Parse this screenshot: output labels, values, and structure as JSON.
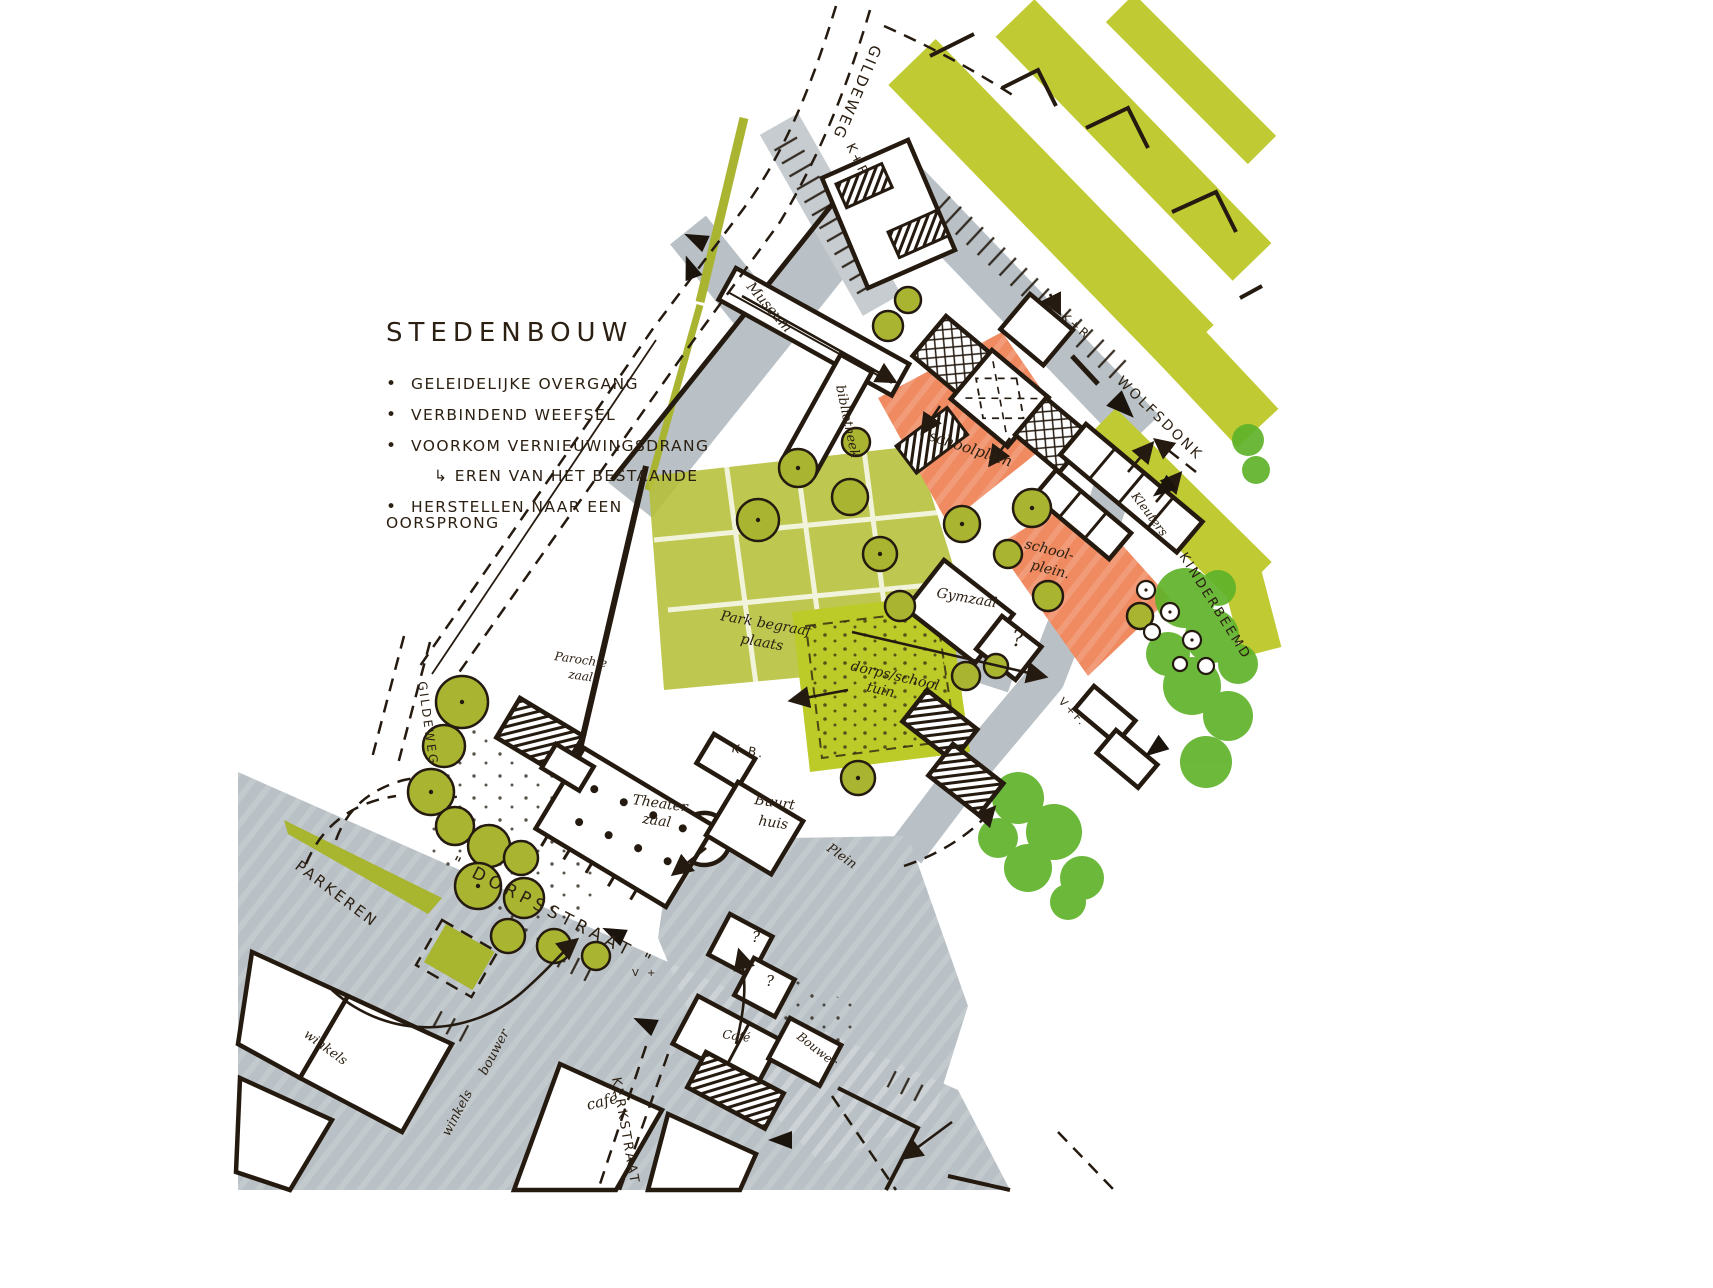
{
  "annotation": {
    "title": "STEDENBOUW",
    "bullets": [
      "GELEIDELIJKE OVERGANG",
      "VERBINDEND WEEFSEL",
      "VOORKOM VERNIEUWINGSDRANG",
      "↳ EREN VAN HET BESTAANDE",
      "HERSTELLEN NAAR EEN OORSPRONG"
    ]
  },
  "colors": {
    "road_gray": "#b9c1c6",
    "kr_gray": "#c6ccd0",
    "marker_olive": "#c0ca33",
    "cemetery_olive": "#b5bf37",
    "tuin_green": "#bccb28",
    "tree_olive": "#a9b431",
    "orange": "#ef8a61",
    "bright_green": "#5fb32a",
    "ink": "#241a10"
  },
  "map": {
    "labels": [
      {
        "id": "gildeweg-top",
        "text": "GILDEWEG",
        "x": 872,
        "y": 44,
        "rot": 113,
        "fs": 15,
        "cls": "caps"
      },
      {
        "id": "kr-top",
        "text": "K+R",
        "x": 846,
        "y": 146,
        "rot": 64,
        "fs": 13,
        "cls": "caps"
      },
      {
        "id": "museum",
        "text": "Museum",
        "x": 746,
        "y": 287,
        "rot": 49,
        "fs": 14,
        "cls": "hand"
      },
      {
        "id": "bibliotheek",
        "text": "bibliotheek",
        "x": 836,
        "y": 386,
        "rot": 78,
        "fs": 13,
        "cls": "hand"
      },
      {
        "id": "kr-2",
        "text": "↓ K+R",
        "x": 1046,
        "y": 306,
        "rot": 40,
        "fs": 12,
        "cls": "caps"
      },
      {
        "id": "wolfsdonk",
        "text": "WOLFSDONK",
        "x": 1116,
        "y": 382,
        "rot": 44,
        "fs": 14,
        "cls": "caps"
      },
      {
        "id": "schoolplein-boven",
        "text": "schoolplein",
        "x": 928,
        "y": 440,
        "rot": 18,
        "fs": 15,
        "cls": "hand"
      },
      {
        "id": "schoolplein-onder-a",
        "text": "school-",
        "x": 1024,
        "y": 548,
        "rot": 14,
        "fs": 14,
        "cls": "hand"
      },
      {
        "id": "schoolplein-onder-b",
        "text": "plein.",
        "x": 1030,
        "y": 569,
        "rot": 14,
        "fs": 14,
        "cls": "hand"
      },
      {
        "id": "kleuters",
        "text": "Kleuters",
        "x": 1131,
        "y": 496,
        "rot": 53,
        "fs": 12,
        "cls": "hand"
      },
      {
        "id": "kinderbeemd",
        "text": "KINDERBEEMD",
        "x": 1179,
        "y": 556,
        "rot": 58,
        "fs": 13,
        "cls": "caps"
      },
      {
        "id": "gymzaal",
        "text": "Gymzaal",
        "x": 936,
        "y": 597,
        "rot": 10,
        "fs": 14,
        "cls": "hand"
      },
      {
        "id": "vraagteken-gym",
        "text": "?",
        "x": 1012,
        "y": 646,
        "rot": 0,
        "fs": 22,
        "cls": "hand"
      },
      {
        "id": "vf",
        "text": "V+F.",
        "x": 1058,
        "y": 702,
        "rot": 46,
        "fs": 11,
        "cls": "caps"
      },
      {
        "id": "tuin-a",
        "text": "dorps/school",
        "x": 850,
        "y": 670,
        "rot": 13,
        "fs": 14,
        "cls": "hand"
      },
      {
        "id": "tuin-b",
        "text": "tuin",
        "x": 866,
        "y": 691,
        "rot": 13,
        "fs": 14,
        "cls": "hand"
      },
      {
        "id": "begraaf-a",
        "text": "Park begraaf",
        "x": 720,
        "y": 620,
        "rot": 10,
        "fs": 14,
        "cls": "hand"
      },
      {
        "id": "begraaf-b",
        "text": "plaats",
        "x": 740,
        "y": 643,
        "rot": 10,
        "fs": 14,
        "cls": "hand"
      },
      {
        "id": "parochie-a",
        "text": "Parochie",
        "x": 554,
        "y": 660,
        "rot": 8,
        "fs": 12,
        "cls": "hand"
      },
      {
        "id": "parochie-b",
        "text": "zaal",
        "x": 568,
        "y": 678,
        "rot": 8,
        "fs": 12,
        "cls": "hand"
      },
      {
        "id": "gildeweg-links",
        "text": "GILDEWEG",
        "x": 418,
        "y": 682,
        "rot": 82,
        "fs": 12,
        "cls": "caps"
      },
      {
        "id": "kb",
        "text": "K.B.",
        "x": 731,
        "y": 752,
        "rot": 10,
        "fs": 12,
        "cls": "caps"
      },
      {
        "id": "theater-a",
        "text": "Theater",
        "x": 632,
        "y": 804,
        "rot": 8,
        "fs": 14,
        "cls": "hand"
      },
      {
        "id": "theater-b",
        "text": "zaal",
        "x": 642,
        "y": 823,
        "rot": 8,
        "fs": 14,
        "cls": "hand"
      },
      {
        "id": "buurt-a",
        "text": "Buurt",
        "x": 754,
        "y": 804,
        "rot": 8,
        "fs": 14,
        "cls": "hand"
      },
      {
        "id": "buurt-b",
        "text": "huis",
        "x": 758,
        "y": 825,
        "rot": 8,
        "fs": 14,
        "cls": "hand"
      },
      {
        "id": "plein",
        "text": "Plein",
        "x": 826,
        "y": 850,
        "rot": 35,
        "fs": 13,
        "cls": "hand"
      },
      {
        "id": "parkeren",
        "text": "PARKEREN",
        "x": 294,
        "y": 868,
        "rot": 37,
        "fs": 15,
        "cls": "caps"
      },
      {
        "id": "dorpsstraat",
        "text": "\" DORPSSTRAAT \"",
        "x": 450,
        "y": 866,
        "rot": 27,
        "fs": 17,
        "cls": "caps wide"
      },
      {
        "id": "winkels-rand-a",
        "text": "winkels",
        "x": 449,
        "y": 1137,
        "rot": -62,
        "fs": 13,
        "cls": "hand"
      },
      {
        "id": "winkels-rand-b",
        "text": "bouwer",
        "x": 486,
        "y": 1076,
        "rot": -62,
        "fs": 13,
        "cls": "hand"
      },
      {
        "id": "winkels-links",
        "text": "winkels",
        "x": 303,
        "y": 1036,
        "rot": 36,
        "fs": 13,
        "cls": "hand"
      },
      {
        "id": "cafe-straat",
        "text": "café",
        "x": 588,
        "y": 1110,
        "rot": -14,
        "fs": 15,
        "cls": "hand"
      },
      {
        "id": "cafe-gebouw",
        "text": "Café",
        "x": 722,
        "y": 1038,
        "rot": 8,
        "fs": 12,
        "cls": "hand"
      },
      {
        "id": "vraagteken-1",
        "text": "?",
        "x": 752,
        "y": 942,
        "rot": 0,
        "fs": 15,
        "cls": "hand"
      },
      {
        "id": "vraagteken-2",
        "text": "?",
        "x": 766,
        "y": 986,
        "rot": 0,
        "fs": 15,
        "cls": "hand"
      },
      {
        "id": "bouwer",
        "text": "Bouwer",
        "x": 796,
        "y": 1038,
        "rot": 38,
        "fs": 12,
        "cls": "hand"
      },
      {
        "id": "kerkstraat",
        "text": "KERKSTRAAT",
        "x": 612,
        "y": 1078,
        "rot": 80,
        "fs": 13,
        "cls": "caps"
      },
      {
        "id": "v-plus",
        "text": "V +",
        "x": 632,
        "y": 976,
        "rot": 0,
        "fs": 10,
        "cls": "caps"
      }
    ]
  }
}
